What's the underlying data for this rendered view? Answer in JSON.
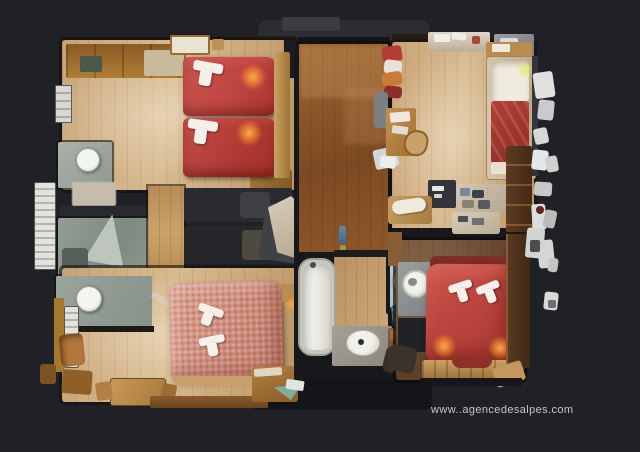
{
  "scene": {
    "type": "3d-dollhouse-floorplan-top-view",
    "description": "Top-down 3D scan floorplan of a chalet apartment with two twin-bed rooms, two double-bed rooms, bathrooms and hallway on a dark background"
  },
  "watermark": {
    "text": "www..agencedesalpes.com"
  },
  "palette": {
    "background": "#1f2126",
    "wood_light": "#c9a377",
    "hall_wood": "#7c4a22",
    "floor_dark": "#5c402a",
    "bed_red": "#bf4540",
    "bed_pink": "#d08f7e",
    "towel": "#f4f1ea",
    "bath_gray": "#93a096",
    "fixture_white": "#f4f5f0",
    "unscanned_gray": "#2b2d32",
    "wall_dark": "#17181c",
    "lamp_glow": "#ff9e3c",
    "watermark_gray": "#c6c6ca"
  }
}
